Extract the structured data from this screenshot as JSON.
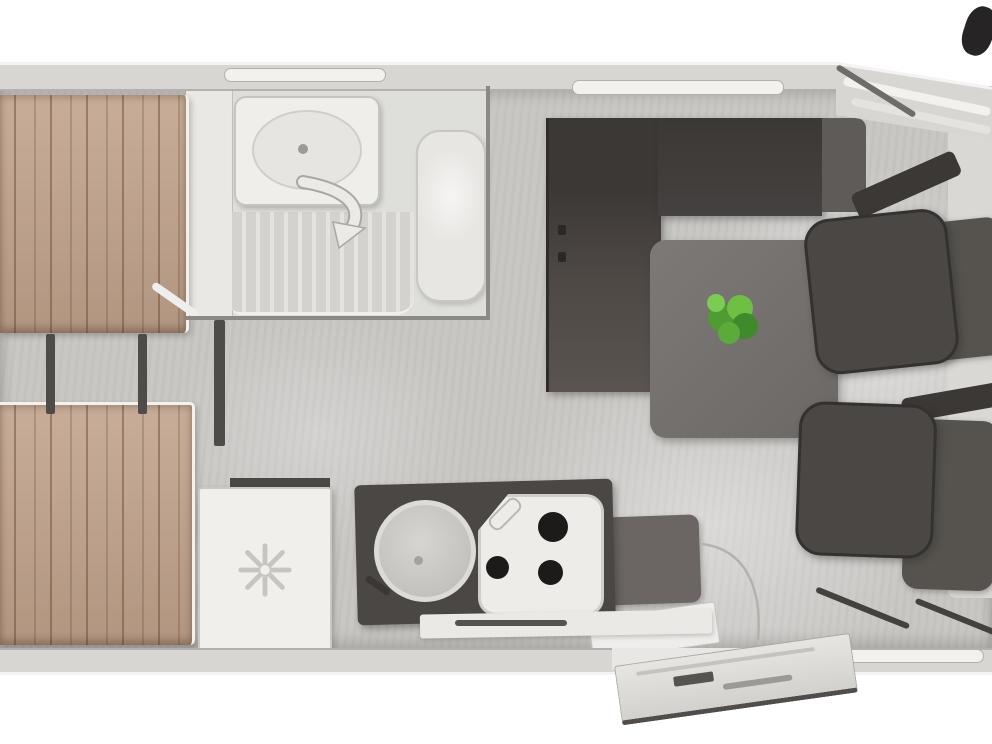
{
  "meta": {
    "title": "Motorhome floor plan — top view",
    "text_visible": false
  },
  "palette": {
    "exterior": "#ffffff",
    "wall": "#d7d6d3",
    "wall-edge": "#b2b1ad",
    "floor": "#c9c7c4",
    "bed": "#c0a28b",
    "furn-dark": "#454140",
    "wardrobe": "#4f4946",
    "table": "#73706c",
    "counter": "#4b4744",
    "fixture": "#efeeeb",
    "chair": "#4a4745",
    "chair-seat": "#56534f",
    "plant": "#5fae3e",
    "arrow": "#eceae7"
  },
  "labels": {
    "canvas": "Motorhome floor plan — top view",
    "wall_top": "Rear/side wall (top)",
    "wall_bottom": "Entry-side wall (bottom)",
    "cab_wall": "Cab bodywork taper",
    "floor": "Interior floor",
    "window_rear": "Window above washroom",
    "window_dinette": "Window above dinette",
    "window_bottom": "Window beside cab door",
    "windshield_stripe": "Cab windscreen edge line",
    "cab_pillar": "Cab A-pillar",
    "wing_mirror": "Wing mirror",
    "dashboard": "Cab dashboard / door trim",
    "bed_upper": "Rear single bed (upper in plan)",
    "bed_lower": "Rear single bed (lower in plan)",
    "bed_trim": "Bed corner trim",
    "ladder_rail": "Bed step / ladder rail",
    "bathroom": "Washroom",
    "bathroom_cabinet": "Washroom cabinet",
    "basin": "Washbasin unit",
    "basin_bowl": "Washbasin bowl",
    "basin_drain": "Basin tap",
    "shower": "Shower tray",
    "toilet": "Toilet",
    "bathroom_wall": "Washroom partition wall",
    "door_swing_arrow": "Washroom door swing arrow",
    "wardrobe": "Wardrobe / partition door",
    "hinge": "Door hinge",
    "sofa": "Dinette bench seat",
    "armrest": "Bench armrest cushion",
    "table": "Dinette table",
    "plant": "Potted plant",
    "stool": "Seat cushion / step stool",
    "door_arc": "Entry door swing arc",
    "counter": "Kitchen worktop",
    "sink": "Kitchen sink",
    "sink_drain": "Sink drain",
    "faucet": "Kitchen tap",
    "hob": "Three-burner gas hob",
    "burner": "Hob burner",
    "hob_grip": "Hob lid handle",
    "ledge": "Kitchen ledge / wall shelf",
    "vent": "Vent slot",
    "fridge": "Refrigerator",
    "snowflake": "Refrigerator snowflake symbol",
    "fridge_strip": "Worktop strip behind refrigerator",
    "passenger_seat": "Swivelled passenger cab seat",
    "driver_seat": "Swivelled driver cab seat",
    "headrest": "Seat headrest",
    "backrest": "Seat backrest",
    "cushion": "Seat cushion",
    "seat_rail": "Seat base rail",
    "doorway": "Entry doorway",
    "door_open": "Entry door (open)",
    "doormat": "Entry step mat"
  }
}
